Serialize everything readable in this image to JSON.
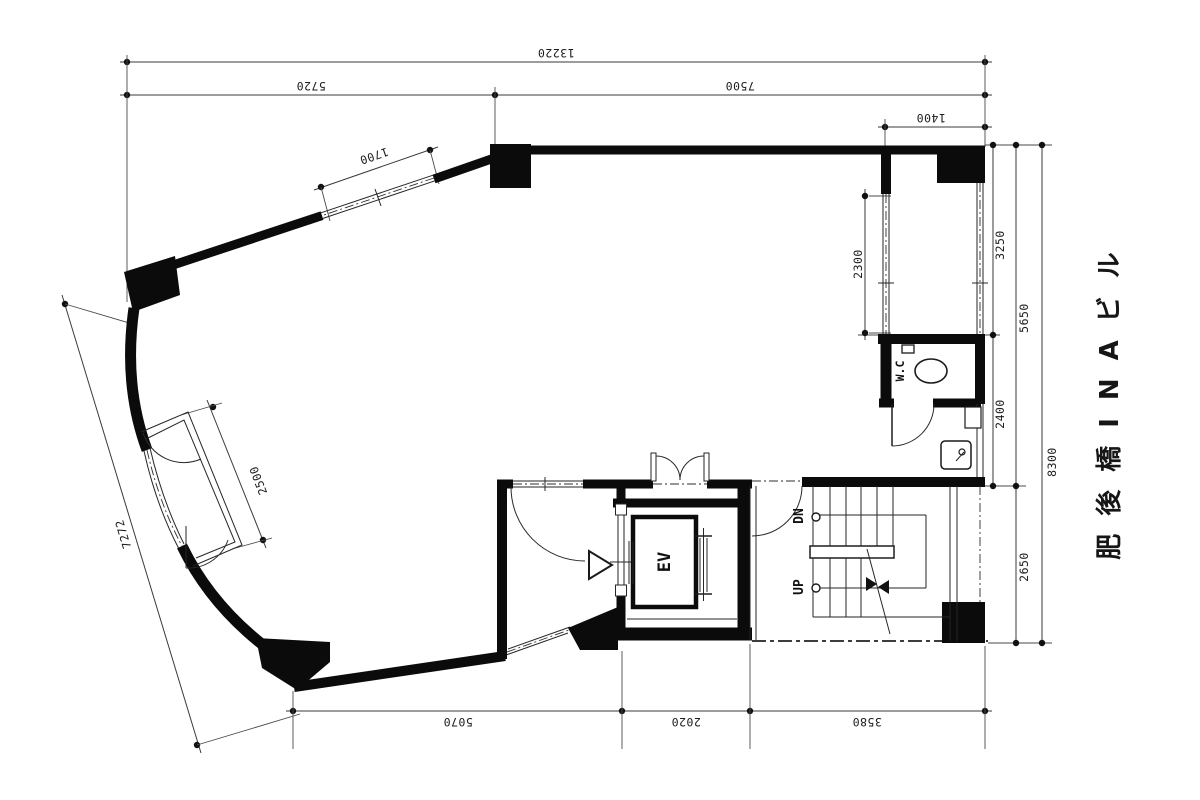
{
  "drawing": {
    "building_name": "肥後橋INAビル",
    "rooms": {
      "elevator_label": "EV",
      "toilet_label": "W.C",
      "stair_up_label": "UP",
      "stair_down_label": "DN"
    },
    "dims": {
      "top": {
        "overall_width": "13220",
        "left_span": "5720",
        "right_span": "7500",
        "balcony_depth": "1400",
        "slant_window": "1700"
      },
      "right": {
        "window_span": "2300",
        "upper": "3250",
        "middle": "2400",
        "upper_total": "5650",
        "lower": "2650",
        "overall_height": "8300"
      },
      "left": {
        "slant_overall": "7272",
        "entry_room": "2500"
      },
      "bottom": {
        "left_span": "5070",
        "elevator_span": "2020",
        "stair_span": "3580"
      }
    }
  }
}
